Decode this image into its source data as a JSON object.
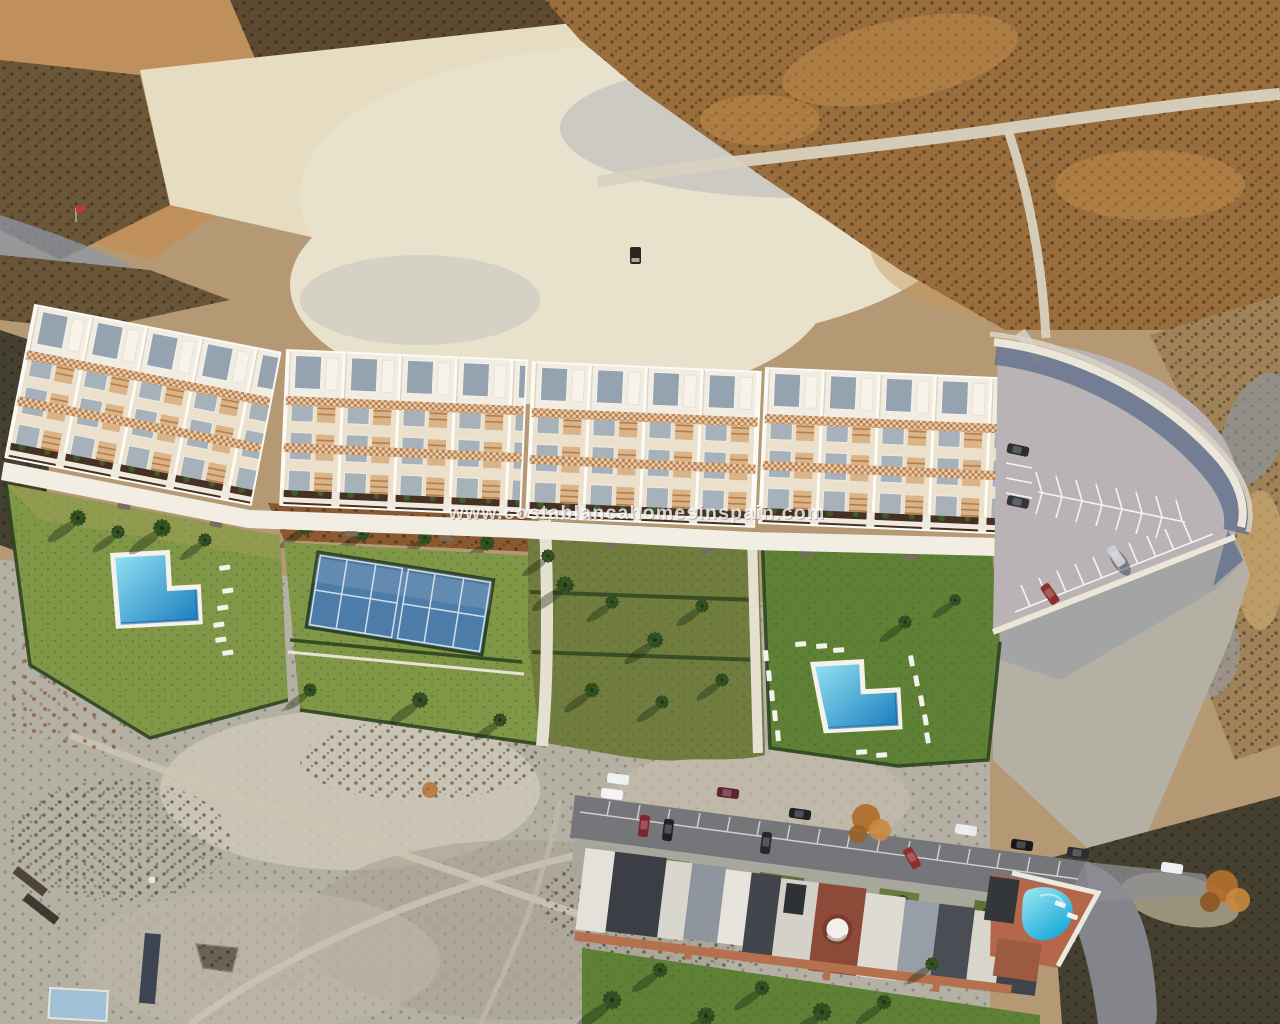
{
  "watermark": {
    "text": "www.costablancahomesinspain.com"
  },
  "colors": {
    "terrain_tan": "#b59975",
    "scrub_gold": "#9a6e3c",
    "chalk": "#e8e1cb",
    "pale_scrub": "#b5b0a4",
    "dark_scrub": "#45402f",
    "lawn_bright": "#7f9747",
    "lawn_deep": "#5e8136",
    "garden_olive": "#707d3f",
    "mulch_brown": "#8a5a2e",
    "court_blue": "#4e7ca8",
    "pool_light": "#8fdff0",
    "pool_deep": "#1d7fc0",
    "parking_gray": "#bab3b5",
    "wall_shadow": "#62708c",
    "road_gray": "#75767a",
    "roof_red": "#8e4a38",
    "pool_existing": "#2cc4ea",
    "watermark_white": "#ffffff"
  }
}
